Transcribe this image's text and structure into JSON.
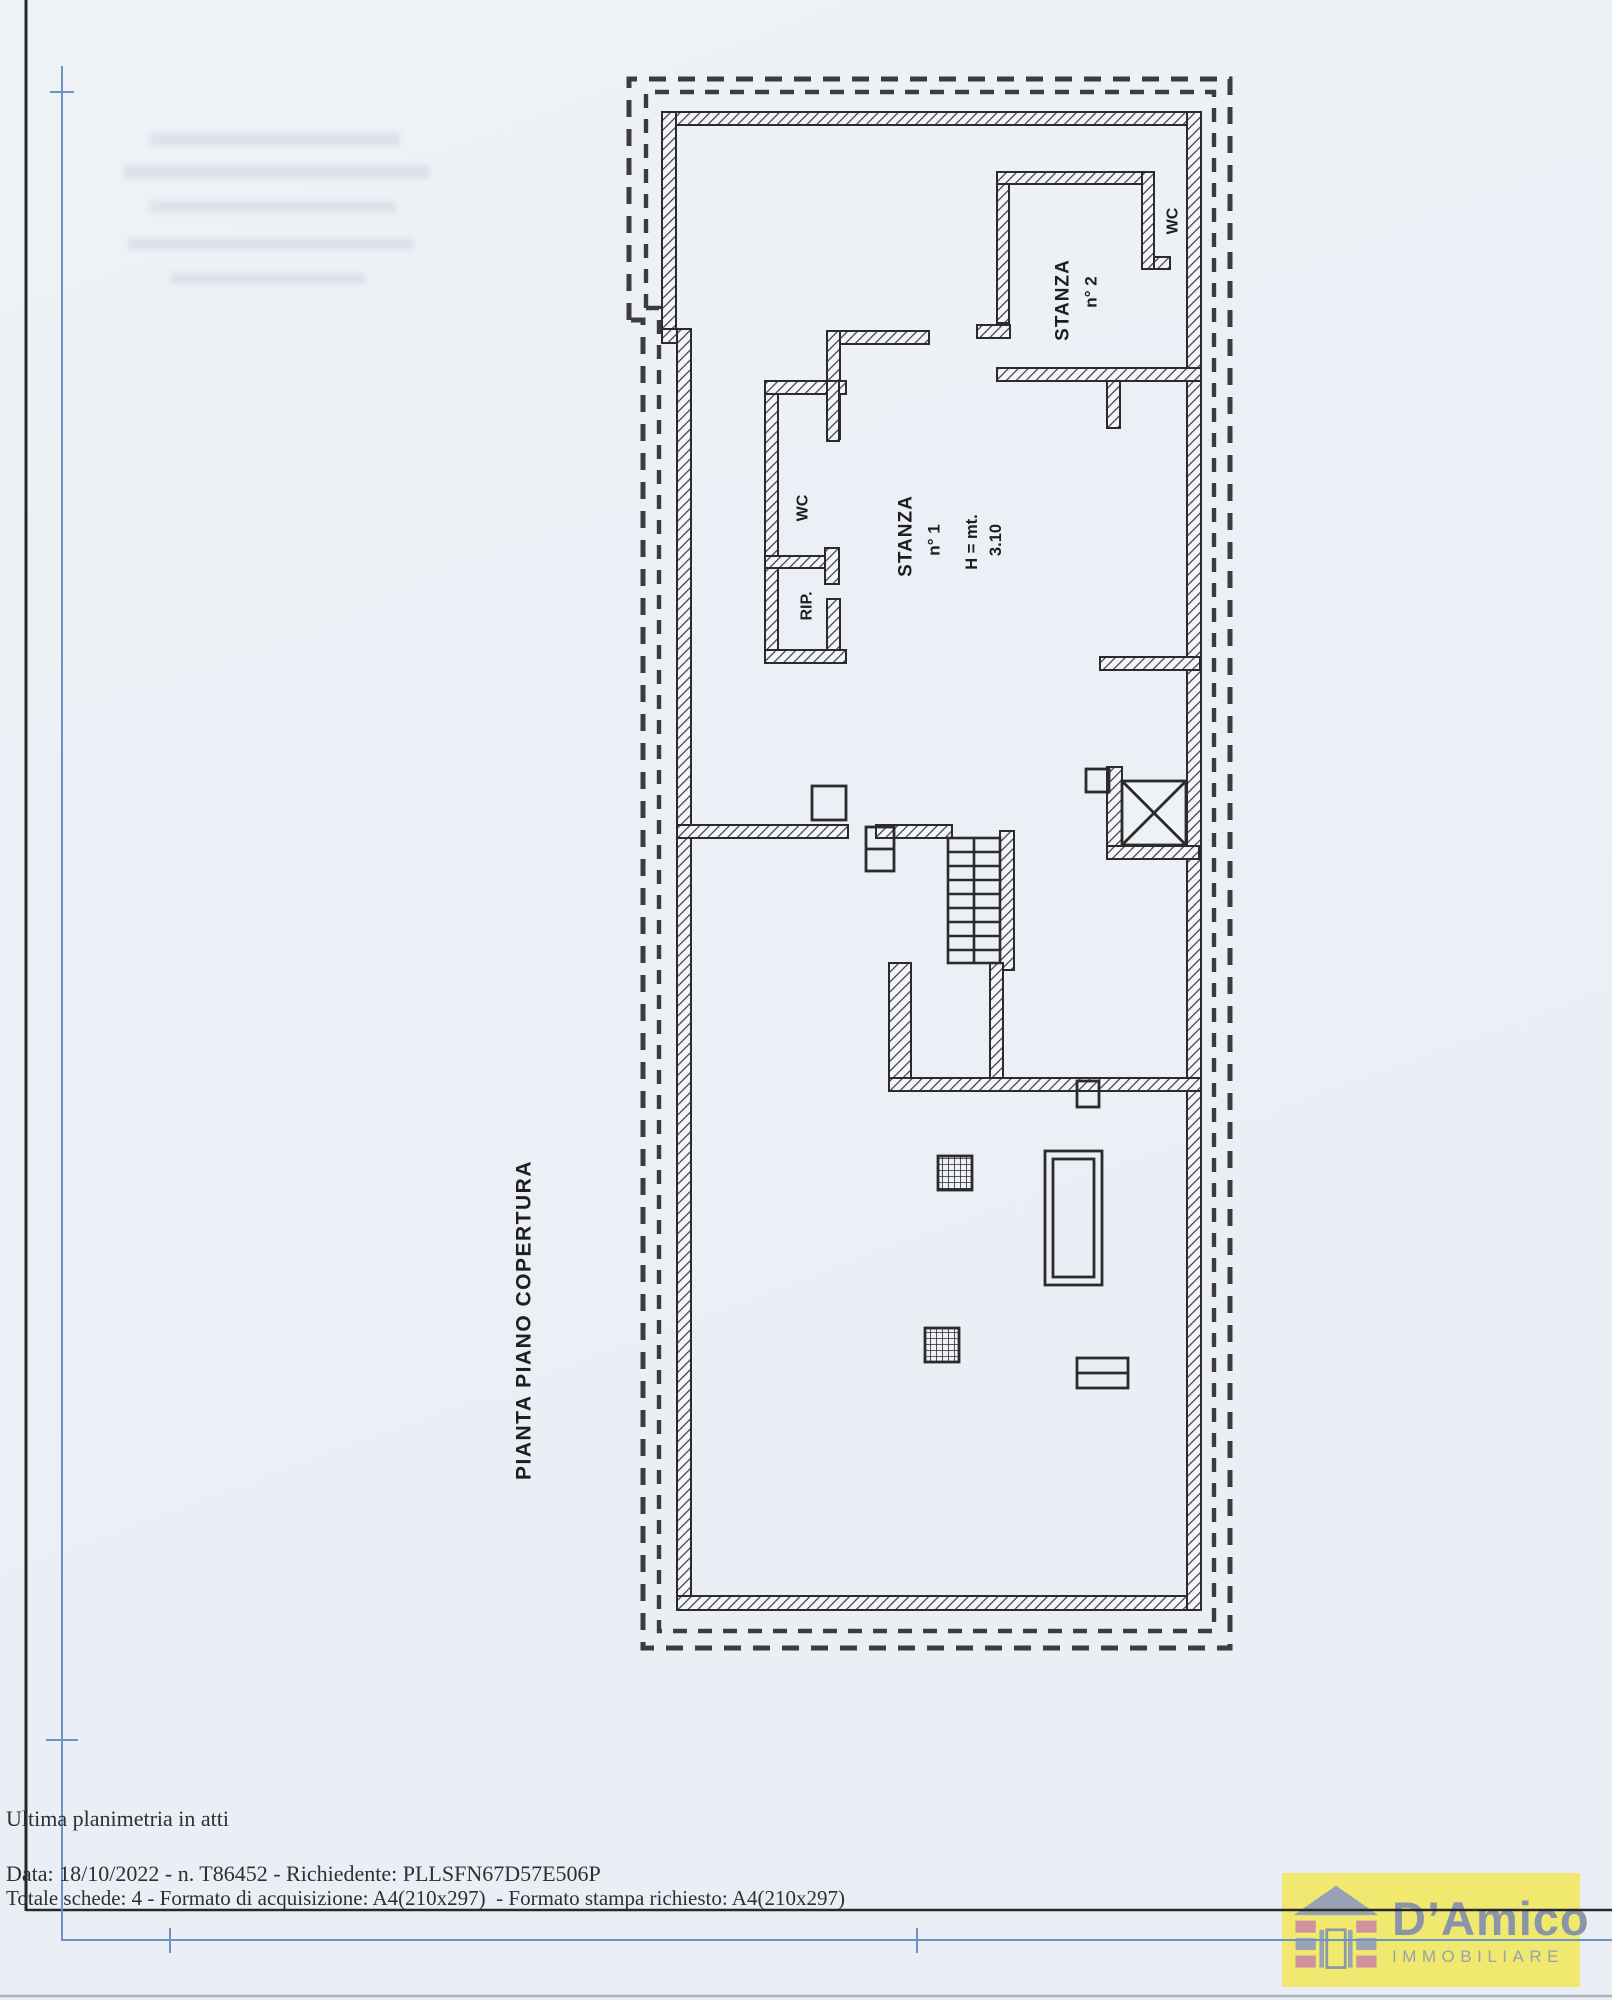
{
  "document": {
    "footer": {
      "note": "Ultima planimetria in atti",
      "line_data": "Data: 18/10/2022 - n. T86452 - Richiedente: PLLSFN67D57E506P",
      "line_schede": "Totale schede: 4 - Formato di acquisizione: A4(210x297)  - Formato stampa richiesto: A4(210x297)"
    }
  },
  "plan": {
    "title": "PIANTA PIANO COPERTURA",
    "rooms": {
      "stanza1": {
        "name": "STANZA",
        "number": "n° 1",
        "height_label": "H = mt.",
        "height_value": "3.10"
      },
      "stanza2": {
        "name": "STANZA",
        "number": "n° 2"
      },
      "wc1": {
        "name": "WC"
      },
      "wc2": {
        "name": "WC"
      },
      "rip": {
        "name": "RIP."
      }
    }
  },
  "logo": {
    "brand": "D’Amico",
    "subtitle": "IMMOBILIARE",
    "bg_color": "#f1e96f",
    "brand_color": "#8b95a9",
    "subtitle_color": "#99a1ad"
  },
  "colors": {
    "paper": "#edf1f6",
    "ink": "#2e2e35",
    "blue_line": "#6b93c4",
    "frame": "#26262b",
    "wall": "#2b2b2b"
  }
}
